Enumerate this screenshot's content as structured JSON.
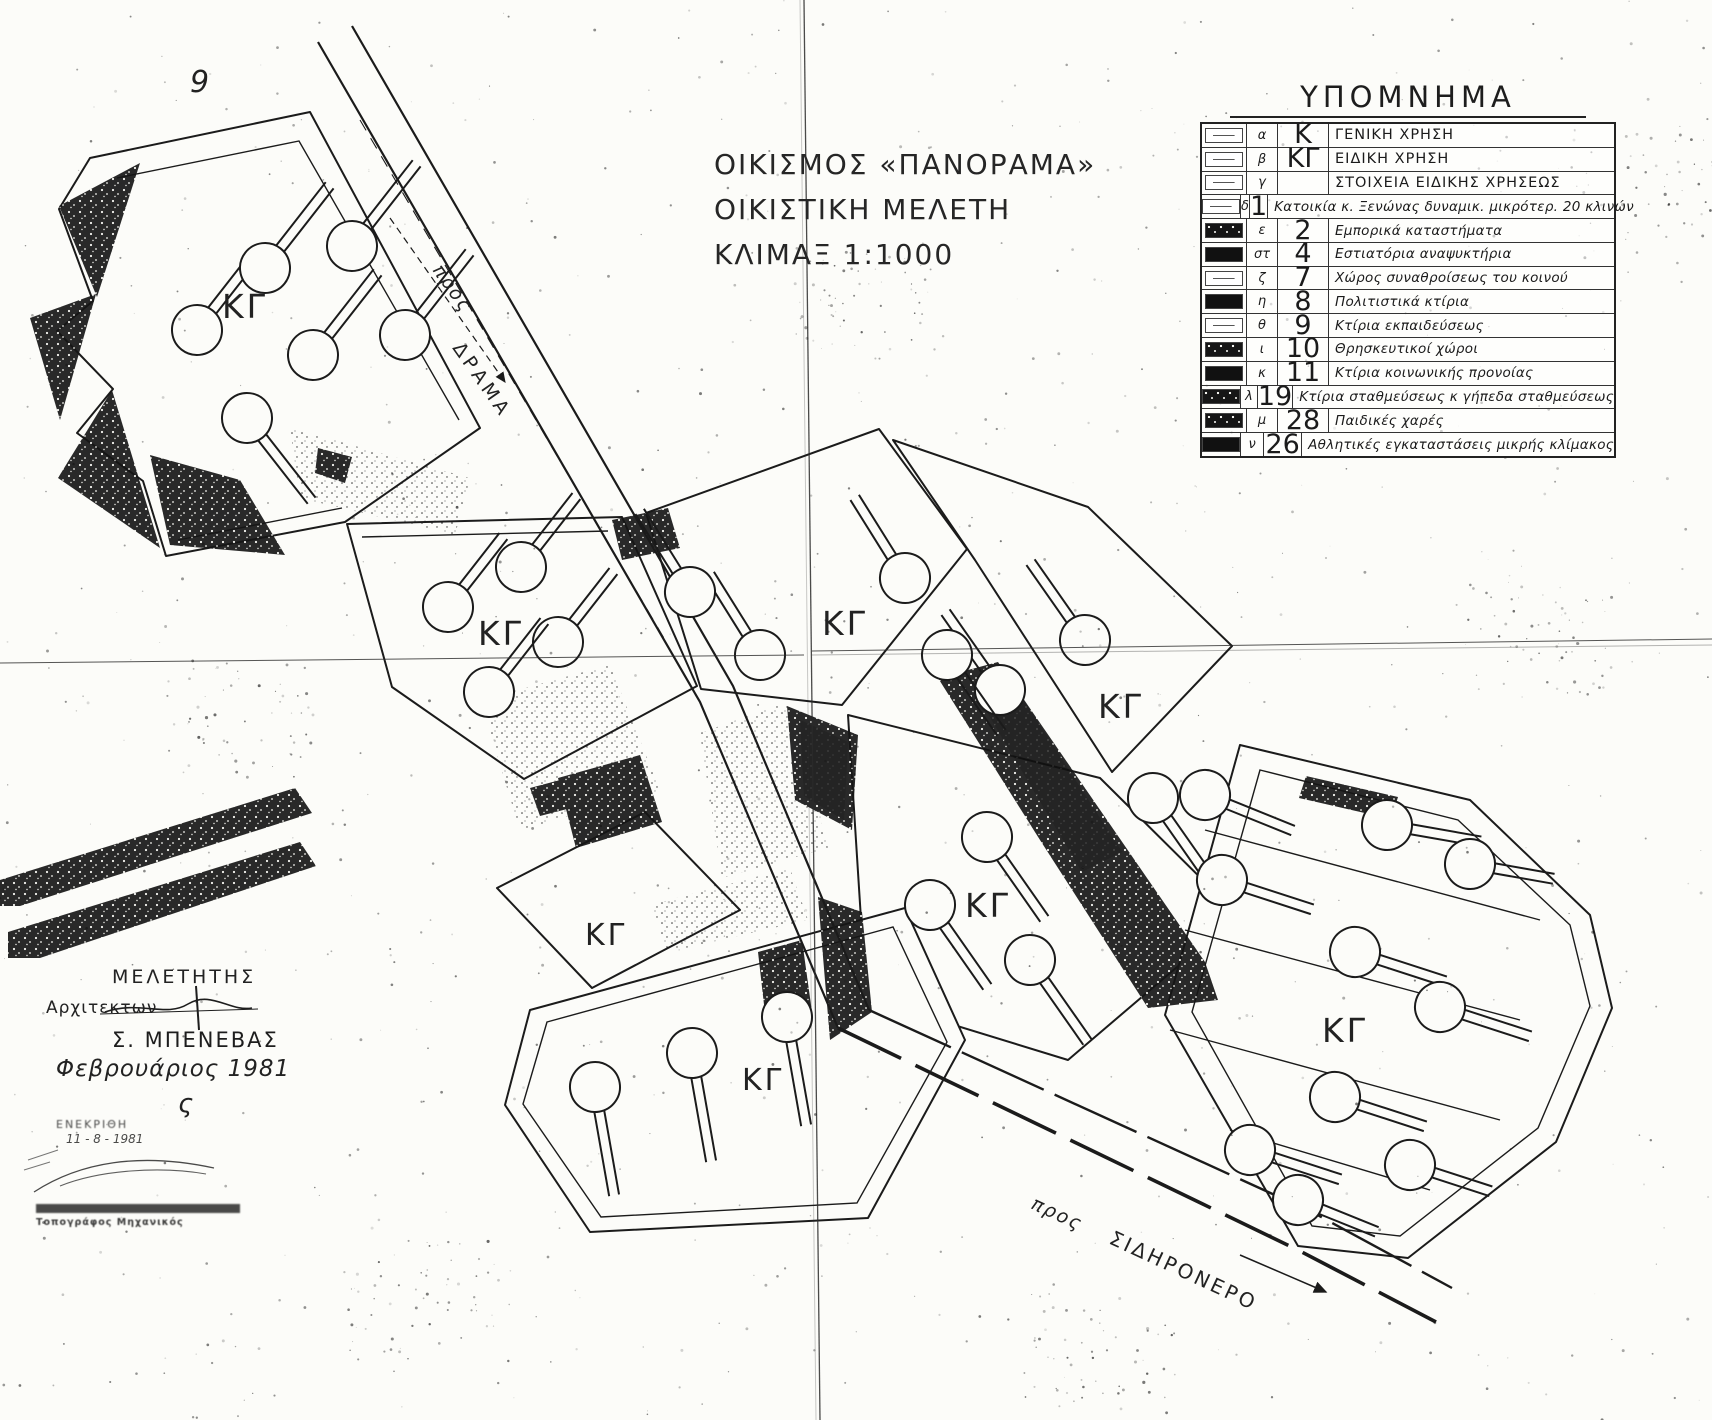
{
  "title": {
    "line1": "ΟΙΚΙΣΜΟΣ «ΠΑΝΟΡΑΜΑ»",
    "line2": "ΟΙΚΙΣΤΙΚΗ ΜΕΛΕΤΗ",
    "line3": "ΚΛΙΜΑΞ 1:1000"
  },
  "legend": {
    "title": "ΥΠΟΜΝΗΜΑ",
    "rows": [
      {
        "letter": "α",
        "code": "Κ",
        "label": "ΓΕΝΙΚΗ ΧΡΗΣΗ",
        "swatch": "white",
        "big_code": true
      },
      {
        "letter": "β",
        "code": "ΚΓ",
        "label": "ΕΙΔΙΚΗ ΧΡΗΣΗ",
        "swatch": "white",
        "big_code": true
      },
      {
        "letter": "γ",
        "code": "",
        "label": "ΣΤΟΙΧΕΙΑ ΕΙΔΙΚΗΣ ΧΡΗΣΕΩΣ",
        "swatch": "white",
        "big_code": false
      },
      {
        "letter": "δ",
        "code": "1",
        "label": "Κατοικία κ. Ξενώνας δυναμικ. μικρότερ. 20 κλινών",
        "swatch": "white",
        "big_code": true
      },
      {
        "letter": "ε",
        "code": "2",
        "label": "Εμπορικά καταστήματα",
        "swatch": "dark",
        "big_code": true
      },
      {
        "letter": "στ",
        "code": "4",
        "label": "Εστιατόρια αναψυκτήρια",
        "swatch": "black",
        "big_code": true
      },
      {
        "letter": "ζ",
        "code": "7",
        "label": "Χώρος συναθροίσεως του κοινού",
        "swatch": "white",
        "big_code": true
      },
      {
        "letter": "η",
        "code": "8",
        "label": "Πολιτιστικά κτίρια",
        "swatch": "black",
        "big_code": true
      },
      {
        "letter": "θ",
        "code": "9",
        "label": "Κτίρια εκπαιδεύσεως",
        "swatch": "white",
        "big_code": true
      },
      {
        "letter": "ι",
        "code": "10",
        "label": "Θρησκευτικοί χώροι",
        "swatch": "dark",
        "big_code": true
      },
      {
        "letter": "κ",
        "code": "11",
        "label": "Κτίρια κοινωνικής προνοίας",
        "swatch": "black",
        "big_code": true
      },
      {
        "letter": "λ",
        "code": "19",
        "label": "Κτίρια σταθμεύσεως κ γήπεδα σταθμεύσεως",
        "swatch": "dark",
        "big_code": true
      },
      {
        "letter": "μ",
        "code": "28",
        "label": "Παιδικές χαρές",
        "swatch": "dark",
        "big_code": true
      },
      {
        "letter": "ν",
        "code": "26",
        "label": "Αθλητικές εγκαταστάσεις μικρής κλίμακος",
        "swatch": "black",
        "big_code": true
      }
    ]
  },
  "map": {
    "kg_label": "ΚΓ",
    "handwritten_mark": "9",
    "squiggle_mark": "ς",
    "road_drama": {
      "pros": "προς",
      "name": "ΔΡΑΜΑ"
    },
    "road_sidironero": {
      "pros": "προς",
      "name": "ΣΙΔΗΡΟΝΕΡΟ"
    }
  },
  "credits": {
    "heading": "ΜΕΛΕΤΗΤΗΣ",
    "profession": "Αρχιτεκτων",
    "name": "Σ. ΜΠΕΝΕΒΑΣ",
    "date": "Φεβρουάριος 1981"
  },
  "stamp": {
    "approval": "ΕΝΕΚΡΙΘΗ",
    "date": "11 - 8 - 1981",
    "title_line": "Τοπογράφος Μηχανικός"
  },
  "colors": {
    "ink": "#1b1b1b",
    "paper": "#fcfcf9"
  }
}
